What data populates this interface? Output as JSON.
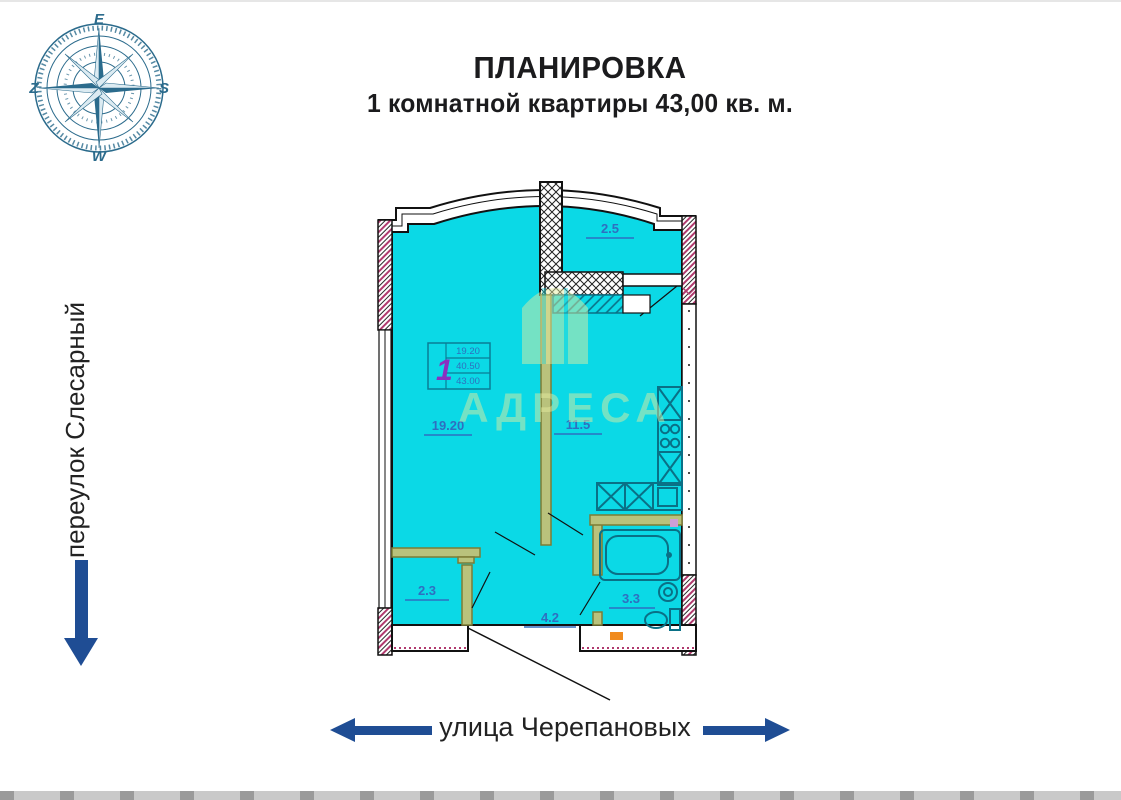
{
  "title": {
    "line1": "ПЛАНИРОВКА",
    "line2": "1 комнатной квартиры 43,00 кв. м."
  },
  "compass": {
    "top": "E",
    "right": "S",
    "bottom": "W",
    "left": "Z"
  },
  "streets": {
    "left_street": "переулок Слесарный",
    "bottom_street": "улица Черепановых"
  },
  "plan": {
    "room_labels": {
      "living": "19.20",
      "kitchen": "11.5",
      "balcony": "2.5",
      "closet": "2.3",
      "hallway": "4.2",
      "bathroom": "3.3"
    },
    "stamp": {
      "room_count": "1",
      "row1": "19.20",
      "row2": "40.50",
      "row3": "43.00"
    }
  },
  "watermark": {
    "text": "АДРЕСА"
  },
  "colors": {
    "plan_fill": "#0bd9e6",
    "label_blue": "#2e6fc0",
    "arrow_blue": "#1f4d94",
    "partition_olive": "#b9c27c",
    "fixture_teal": "#0a7086",
    "hatch_pink": "#b03a6e",
    "stamp_purple": "#8a30c0",
    "watermark_yellow": "#e6eda0",
    "accent_orange": "#f08a1d",
    "compass_teal": "#2b6b8c"
  }
}
